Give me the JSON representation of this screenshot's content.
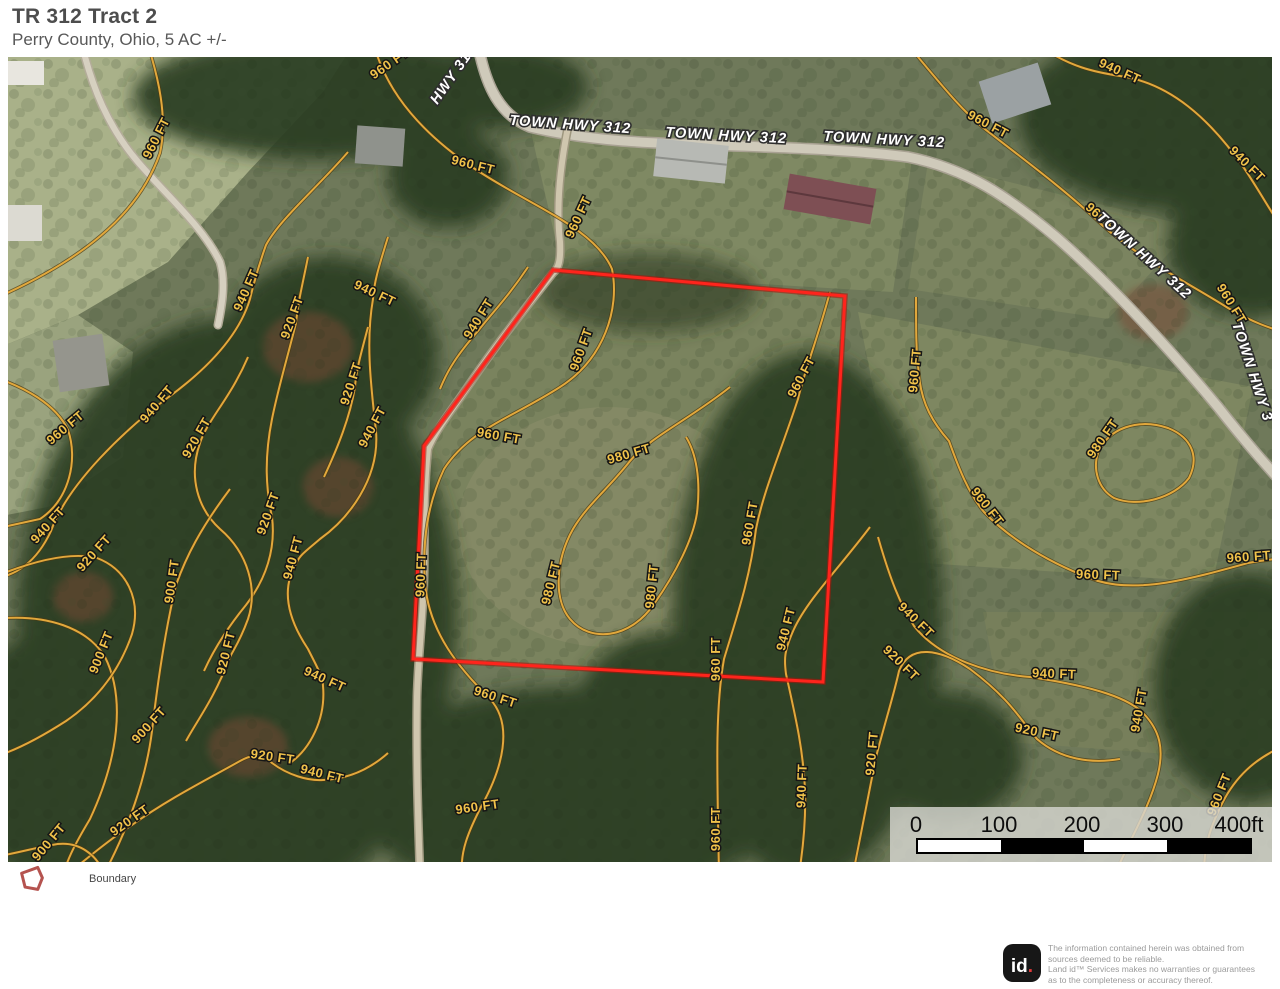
{
  "header": {
    "title": "TR 312 Tract 2",
    "subtitle": "Perry County, Ohio, 5 AC +/-"
  },
  "legend": {
    "items": [
      {
        "label": "Boundary",
        "color": "#b5534f"
      }
    ]
  },
  "footer": {
    "logo_text": "id",
    "logo_dot": ".",
    "disclaimer_lines": [
      "The information contained herein was obtained from",
      "sources deemed to be reliable.",
      "  Land id™  Services makes no warranties or guarantees",
      "as to the completeness or accuracy thereof."
    ]
  },
  "map": {
    "contour_color": "#e2a83c",
    "contour_casing": "#4a3a12",
    "boundary": {
      "points": "545,213 837,239 815,625 405,602 416,389",
      "stroke": "#ff241c",
      "under": "#b01208"
    },
    "roads": [
      {
        "d": "M 470,-12 C 478,30 492,58 522,70 C 580,84 640,86 700,88 C 760,90 840,92 900,100 C 960,112 1000,140 1048,180 C 1100,225 1160,290 1210,350 C 1240,388 1258,408 1278,430",
        "w": 9,
        "color": "#cfcaba",
        "casing": "#a8a192"
      },
      {
        "d": "M 560,70 C 552,110 548,150 552,185 C 553,205 550,212 545,216 C 520,248 490,285 465,322 C 445,352 428,372 420,392 C 415,440 417,480 416,520 C 415,560 410,600 409,640 C 408,700 410,760 412,817",
        "w": 6,
        "color": "#cfc6ae",
        "casing": "#9e977f"
      },
      {
        "d": "M 74,-12 C 84,30 100,70 130,105 C 160,140 195,170 212,205 C 218,225 214,248 210,268",
        "w": 6,
        "color": "#d6d0c0",
        "casing": "#b3ac99"
      }
    ],
    "contour_paths": [
      "M -14,242 C 70,205 130,160 152,96 C 160,60 150,20 140,-12",
      "M 366,-12 C 380,40 420,80 464,110 C 520,148 586,170 604,212 C 612,252 596,302 552,330 C 502,362 462,372 436,412 C 420,446 414,482 417,526 C 421,576 452,612 482,642 C 506,668 494,712 474,748 C 460,775 452,795 454,817",
      "M 340,95 C 308,132 272,162 258,188 C 248,216 245,230 242,242 C 230,282 194,316 158,342 C 118,372 60,426 43,474 C 28,506 8,518 -14,522",
      "M 300,200 C 294,230 290,245 288,266 C 279,302 270,332 264,362 C 256,402 258,432 264,460 C 268,492 258,522 238,548 C 220,570 206,592 196,614",
      "M 240,300 C 222,342 200,362 192,386 C 180,420 190,452 212,472 C 240,496 250,532 240,562 C 232,584 226,592 222,600 C 206,642 190,662 178,684",
      "M 222,432 C 192,472 178,500 168,528 C 158,570 150,622 144,674 C 138,722 120,772 96,817",
      "M -14,562 C 40,556 80,572 97,600 C 118,642 110,702 82,762 C 64,792 58,806 56,817",
      "M -14,520 C 20,506 60,494 89,501 C 118,512 134,542 124,577 C 112,612 90,642 58,664 C 30,682 6,694 -14,700",
      "M 60,817 C 90,792 108,778 124,768 C 160,742 200,722 232,704 C 250,694 258,700 264,706 C 280,718 300,724 315,723 C 340,722 362,712 380,696",
      "M 380,180 C 370,212 366,226 365,242 C 358,282 362,322 368,374 C 372,422 340,462 312,482 C 298,494 292,498 289,505 C 272,532 280,562 300,592 C 310,612 315,620 315,629 C 318,662 302,692 282,706",
      "M -14,800 C 10,796 30,790 44,788 C 72,782 90,800 96,817",
      "M 722,330 C 682,362 642,380 622,404 C 600,432 580,447 565,472 C 548,502 545,542 562,562 C 582,586 622,582 646,547 C 668,516 685,482 689,456 C 693,422 688,396 678,380",
      "M 822,235 C 808,287 797,312 790,342 C 772,397 756,432 748,472 C 742,522 728,562 716,602 C 707,652 709,712 711,817",
      "M 862,470 C 832,510 800,542 786,572 C 776,594 776,602 778,617 C 788,662 795,692 797,732 C 798,762 795,792 791,817",
      "M 870,480 C 882,522 892,547 906,569 C 932,602 982,617 1022,620 C 1090,630 1122,642 1136,657 C 1152,674 1156,692 1150,717 C 1141,752 1122,782 1107,817",
      "M 845,817 C 856,762 863,727 868,700 C 878,662 886,637 891,614 C 902,586 932,592 962,612 C 1002,642 1012,662 1029,682 C 1052,702 1082,707 1112,702",
      "M 908,240 C 908,272 908,297 911,317 C 913,347 926,367 941,384 C 951,412 961,437 976,455 C 1002,482 1042,507 1090,524 C 1132,536 1182,522 1240,506 C 1256,503 1266,502 1278,501",
      "M 1090,396 C 1100,371 1130,361 1160,371 C 1185,381 1191,401 1181,421 C 1166,441 1130,451 1106,441 C 1089,431 1085,411 1090,396 Z",
      "M 1030,-12 C 1062,10 1086,15 1112,19 C 1162,26 1202,62 1236,111 C 1256,141 1266,161 1278,176",
      "M 900,-12 C 932,26 952,52 978,73 C 1022,107 1062,137 1094,168 C 1132,202 1182,227 1220,251 C 1246,266 1262,271 1278,276",
      "M 1278,688 C 1250,700 1231,716 1217,741 C 1201,771 1196,791 1196,817",
      "M 520,210 C 500,240 484,256 470,274 C 450,297 440,312 432,332",
      "M 360,270 C 352,300 348,315 347,330 C 342,360 330,390 316,420",
      "M -14,320 C 16,330 48,347 60,373 C 70,402 62,442 32,462 L -14,472"
    ],
    "contour_labels": [
      {
        "t": "960 FT",
        "x": 152,
        "y": 83,
        "r": -63
      },
      {
        "t": "960 FT",
        "x": 384,
        "y": 10,
        "r": -35
      },
      {
        "t": "960 FT",
        "x": 464,
        "y": 112,
        "r": 14
      },
      {
        "t": "960 FT",
        "x": 574,
        "y": 162,
        "r": -65
      },
      {
        "t": "940 FT",
        "x": 242,
        "y": 235,
        "r": -66
      },
      {
        "t": "920 FT",
        "x": 288,
        "y": 262,
        "r": -70
      },
      {
        "t": "940 FT",
        "x": 365,
        "y": 240,
        "r": 25
      },
      {
        "t": "920 FT",
        "x": 347,
        "y": 328,
        "r": -72
      },
      {
        "t": "940 FT",
        "x": 368,
        "y": 372,
        "r": -62
      },
      {
        "t": "960 FT",
        "x": 60,
        "y": 374,
        "r": -40
      },
      {
        "t": "940 FT",
        "x": 152,
        "y": 350,
        "r": -50
      },
      {
        "t": "920 FT",
        "x": 192,
        "y": 383,
        "r": -60
      },
      {
        "t": "940 FT",
        "x": 43,
        "y": 471,
        "r": -48
      },
      {
        "t": "920 FT",
        "x": 89,
        "y": 499,
        "r": -48
      },
      {
        "t": "900 FT",
        "x": 168,
        "y": 525,
        "r": -82
      },
      {
        "t": "920 FT",
        "x": 264,
        "y": 458,
        "r": -70
      },
      {
        "t": "940 FT",
        "x": 289,
        "y": 502,
        "r": -75
      },
      {
        "t": "900 FT",
        "x": 97,
        "y": 597,
        "r": -68
      },
      {
        "t": "920 FT",
        "x": 222,
        "y": 597,
        "r": -76
      },
      {
        "t": "940 FT",
        "x": 315,
        "y": 626,
        "r": 24
      },
      {
        "t": "900 FT",
        "x": 144,
        "y": 671,
        "r": -48
      },
      {
        "t": "920 FT",
        "x": 264,
        "y": 704,
        "r": 8
      },
      {
        "t": "940 FT",
        "x": 313,
        "y": 721,
        "r": 14
      },
      {
        "t": "920 FT",
        "x": 124,
        "y": 767,
        "r": -35
      },
      {
        "t": "900 FT",
        "x": 44,
        "y": 788,
        "r": -50
      },
      {
        "t": "940 FT",
        "x": 474,
        "y": 264,
        "r": -58
      },
      {
        "t": "960 FT",
        "x": 577,
        "y": 294,
        "r": -70
      },
      {
        "t": "960 FT",
        "x": 797,
        "y": 322,
        "r": -62
      },
      {
        "t": "960 FT",
        "x": 490,
        "y": 383,
        "r": 10
      },
      {
        "t": "980 FT",
        "x": 622,
        "y": 401,
        "r": -16
      },
      {
        "t": "960 FT",
        "x": 417,
        "y": 518,
        "r": -88
      },
      {
        "t": "980 FT",
        "x": 547,
        "y": 527,
        "r": -76
      },
      {
        "t": "980 FT",
        "x": 648,
        "y": 530,
        "r": -84
      },
      {
        "t": "960 FT",
        "x": 746,
        "y": 467,
        "r": -80
      },
      {
        "t": "940 FT",
        "x": 782,
        "y": 573,
        "r": -76
      },
      {
        "t": "960 FT",
        "x": 712,
        "y": 602,
        "r": -90
      },
      {
        "t": "960 FT",
        "x": 486,
        "y": 644,
        "r": 18
      },
      {
        "t": "960 FT",
        "x": 470,
        "y": 754,
        "r": -8
      },
      {
        "t": "960 FT",
        "x": 712,
        "y": 772,
        "r": -90
      },
      {
        "t": "940 FT",
        "x": 798,
        "y": 729,
        "r": -88
      },
      {
        "t": "940 FT",
        "x": 1110,
        "y": 18,
        "r": 24
      },
      {
        "t": "960 FT",
        "x": 978,
        "y": 71,
        "r": 28
      },
      {
        "t": "940 FT",
        "x": 1236,
        "y": 110,
        "r": 45
      },
      {
        "t": "960 FT",
        "x": 1093,
        "y": 166,
        "r": 42
      },
      {
        "t": "960 FT",
        "x": 1220,
        "y": 249,
        "r": 58
      },
      {
        "t": "960 FT",
        "x": 911,
        "y": 314,
        "r": -85
      },
      {
        "t": "980 FT",
        "x": 1098,
        "y": 384,
        "r": -55
      },
      {
        "t": "960 FT",
        "x": 976,
        "y": 452,
        "r": 52
      },
      {
        "t": "960 FT",
        "x": 1241,
        "y": 504,
        "r": -4
      },
      {
        "t": "960 FT",
        "x": 1090,
        "y": 522,
        "r": 2
      },
      {
        "t": "940 FT",
        "x": 905,
        "y": 566,
        "r": 44
      },
      {
        "t": "920 FT",
        "x": 890,
        "y": 609,
        "r": 44
      },
      {
        "t": "940 FT",
        "x": 1046,
        "y": 621,
        "r": 2
      },
      {
        "t": "940 FT",
        "x": 1135,
        "y": 654,
        "r": -80
      },
      {
        "t": "920 FT",
        "x": 1028,
        "y": 679,
        "r": 12
      },
      {
        "t": "920 FT",
        "x": 868,
        "y": 697,
        "r": -85
      },
      {
        "t": "960 FT",
        "x": 1215,
        "y": 739,
        "r": -68
      }
    ],
    "road_labels": [
      {
        "t": "HWY 312",
        "x": 449,
        "y": 20,
        "r": -55
      },
      {
        "t": "TOWN HWY 312",
        "x": 562,
        "y": 72,
        "r": 4
      },
      {
        "t": "TOWN HWY 312",
        "x": 718,
        "y": 83,
        "r": 3
      },
      {
        "t": "TOWN HWY 312",
        "x": 876,
        "y": 87,
        "r": 3
      },
      {
        "t": "TOWN HWY 312",
        "x": 1133,
        "y": 202,
        "r": 42
      },
      {
        "t": "TOWN HWY 3",
        "x": 1240,
        "y": 316,
        "r": 72
      }
    ],
    "scalebar": {
      "ticks": [
        {
          "label": "0",
          "x": 26
        },
        {
          "label": "100",
          "x": 109
        },
        {
          "label": "200",
          "x": 192
        },
        {
          "label": "300",
          "x": 275
        },
        {
          "label": "400ft",
          "x": 349
        }
      ],
      "bar": {
        "x": 26,
        "seg_w": 83,
        "segments": [
          "#ffffff",
          "#000000",
          "#ffffff",
          "#000000"
        ]
      }
    }
  }
}
